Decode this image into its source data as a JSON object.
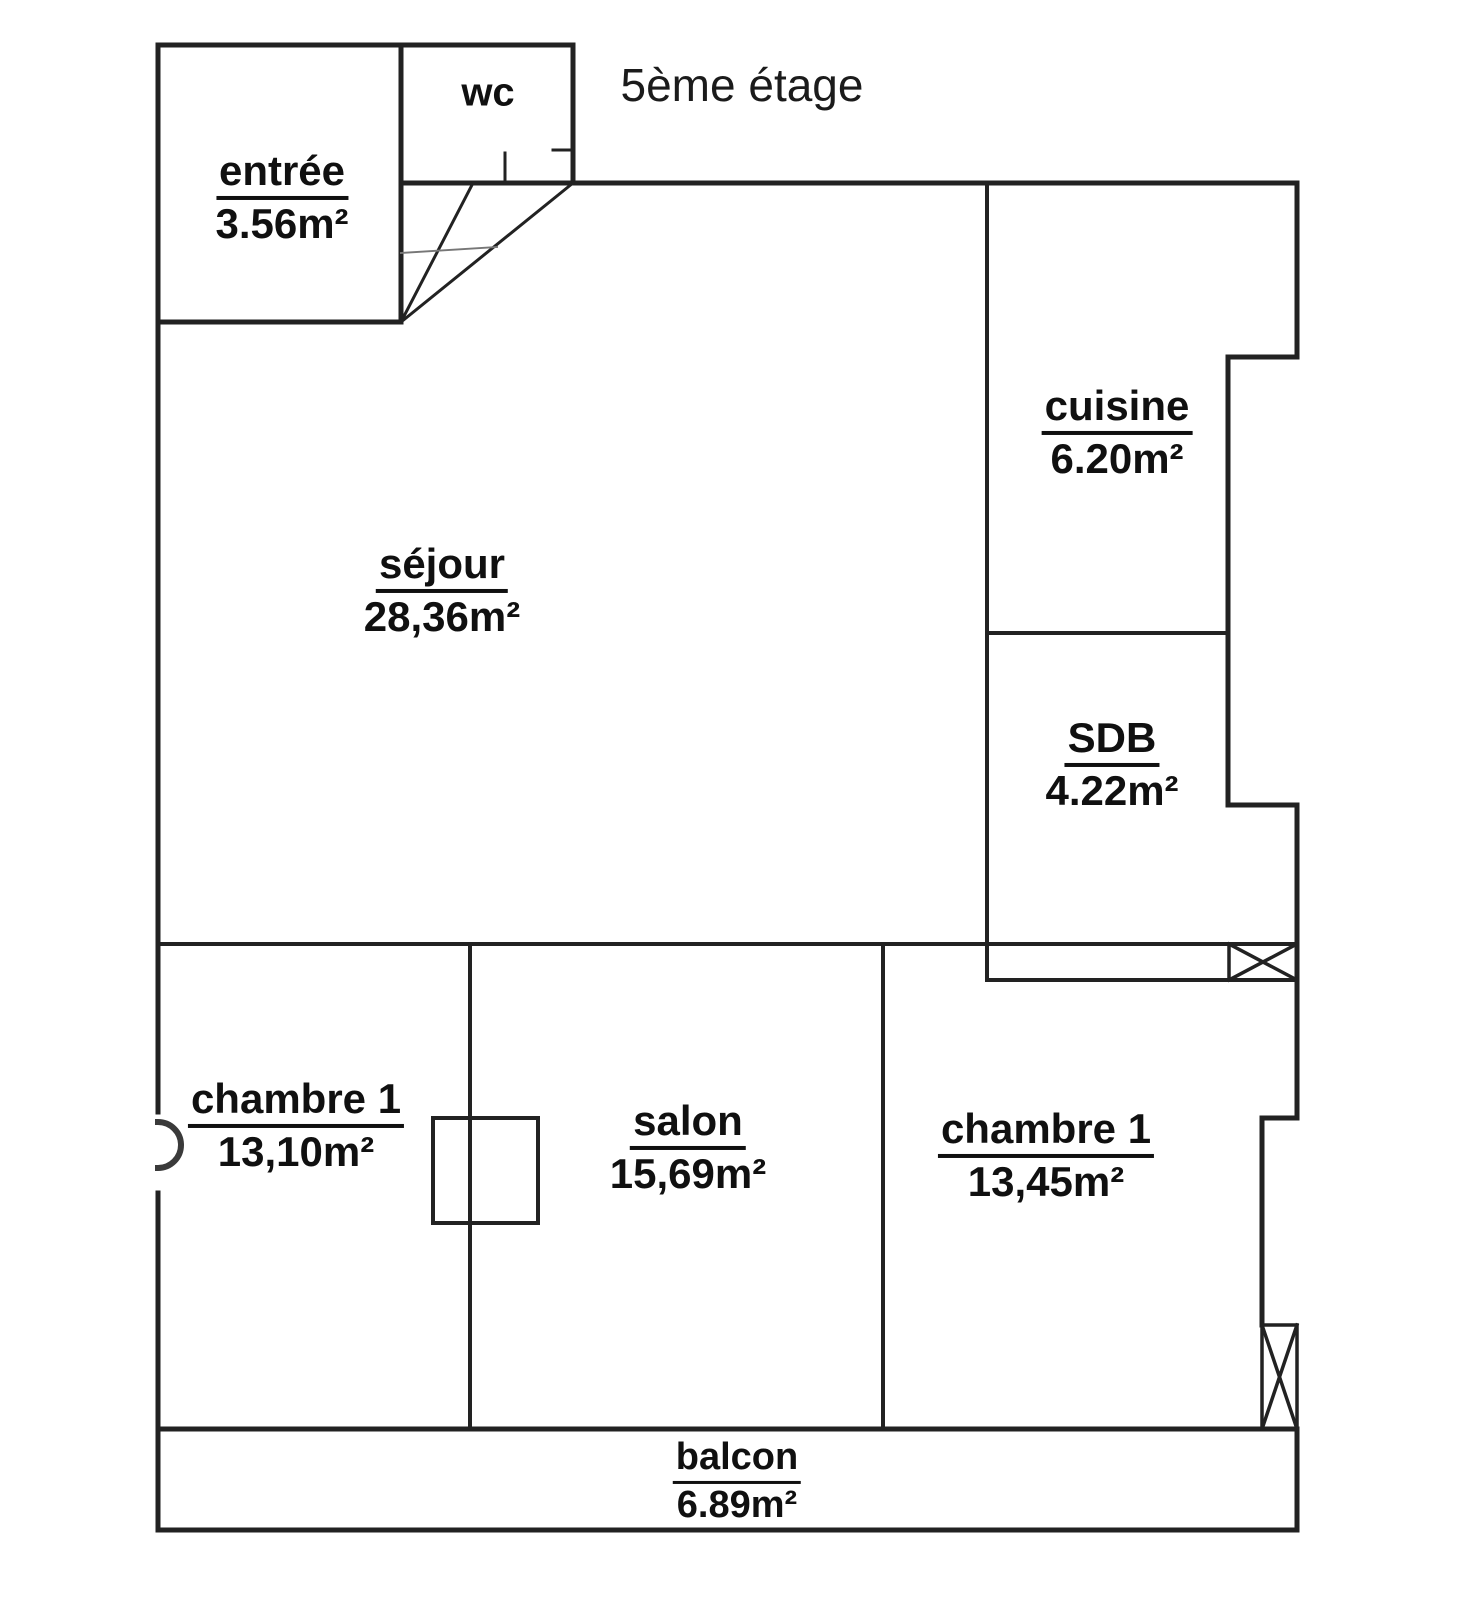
{
  "title": "5ème étage",
  "colors": {
    "wall": "#222222",
    "text": "#101010",
    "background": "#ffffff",
    "faint_line": "#777777"
  },
  "rooms": {
    "entree": {
      "name": "entrée",
      "area": "3.56m²"
    },
    "wc": {
      "name": "wc"
    },
    "cuisine": {
      "name": "cuisine",
      "area": "6.20m²"
    },
    "sejour": {
      "name": "séjour",
      "area": "28,36m²"
    },
    "sdb": {
      "name": "SDB",
      "area": "4.22m²"
    },
    "chambre1_left": {
      "name": "chambre 1",
      "area": "13,10m²"
    },
    "salon": {
      "name": "salon",
      "area": "15,69m²"
    },
    "chambre1_right": {
      "name": "chambre 1",
      "area": "13,45m²"
    },
    "balcon": {
      "name": "balcon",
      "area": "6.89m²"
    }
  }
}
